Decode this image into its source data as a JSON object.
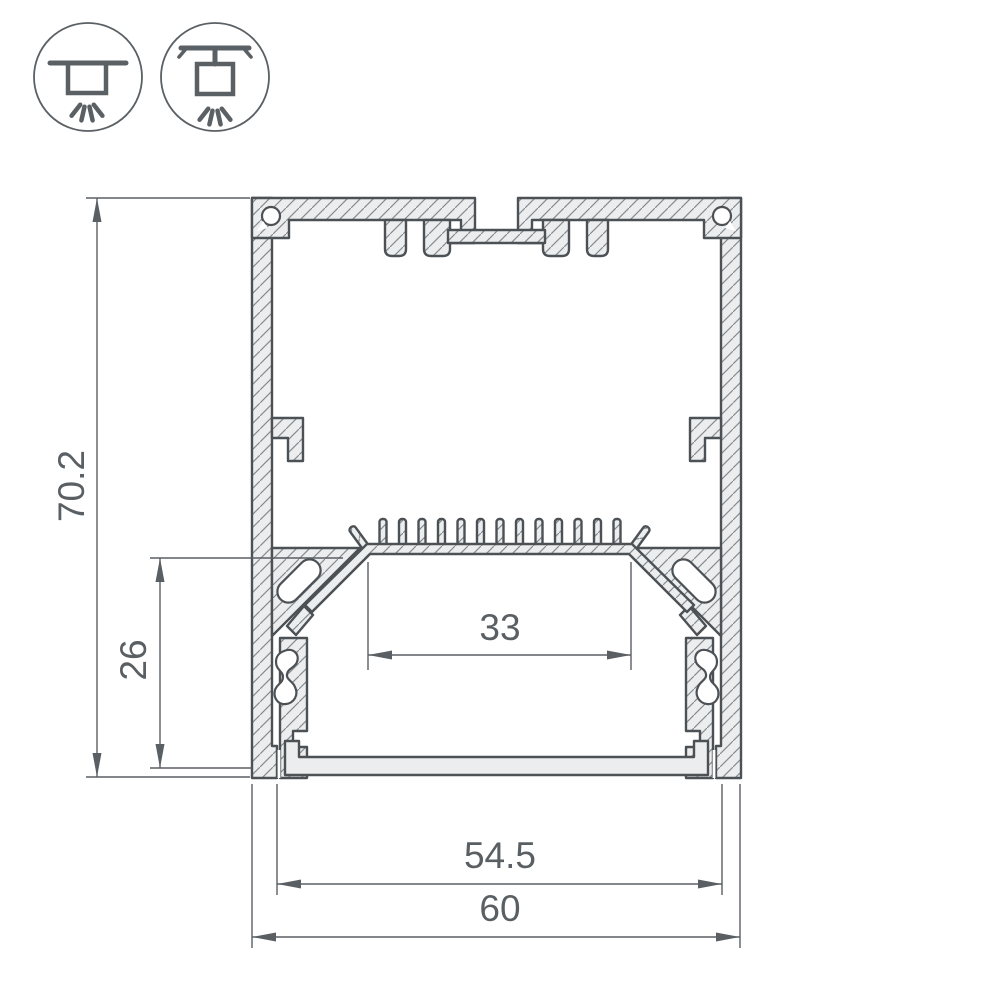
{
  "drawing": {
    "subject": "aluminum-led-profile-cross-section",
    "dimensions": {
      "overall_height": "70.2",
      "inner_height": "26",
      "inner_width": "33",
      "diffuser_width": "54.5",
      "overall_width": "60"
    },
    "icons": {
      "surface": "surface-mounted-luminaire",
      "pendant": "suspended-luminaire"
    },
    "colors": {
      "outline": "#4c5156",
      "metal_fill": "#ecedee",
      "hatch_line": "#868b8f",
      "dimension": "#5a5f63",
      "background": "#ffffff"
    }
  }
}
